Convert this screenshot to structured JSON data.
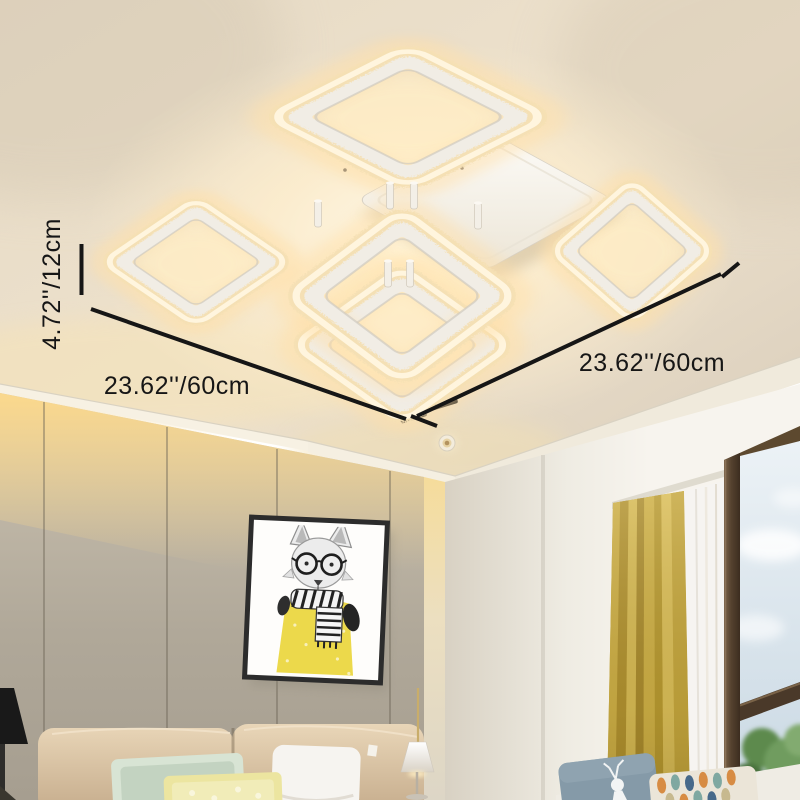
{
  "annotations": {
    "height_label": "4.72''/12cm",
    "width_left_label": "23.62''/60cm",
    "width_right_label": "23.62''/60cm"
  },
  "colors": {
    "dimension_line": "#161616",
    "ceiling": "#e7dbc6",
    "fixture_glow": "#ffeecd",
    "ring_band": "#f5e0b4",
    "ring_frame": "#f1ede5",
    "wall_panel": "#b2aa9c",
    "cove_light": "#fbd994",
    "white_wall": "#f2efe7",
    "curtain": "#c4a741",
    "window_frame": "#55422f",
    "sky": "#dde8ef",
    "foliage": "#6f9c5e",
    "artwork_sweater": "#ecd94b",
    "headboard": "#d9c3a5"
  }
}
